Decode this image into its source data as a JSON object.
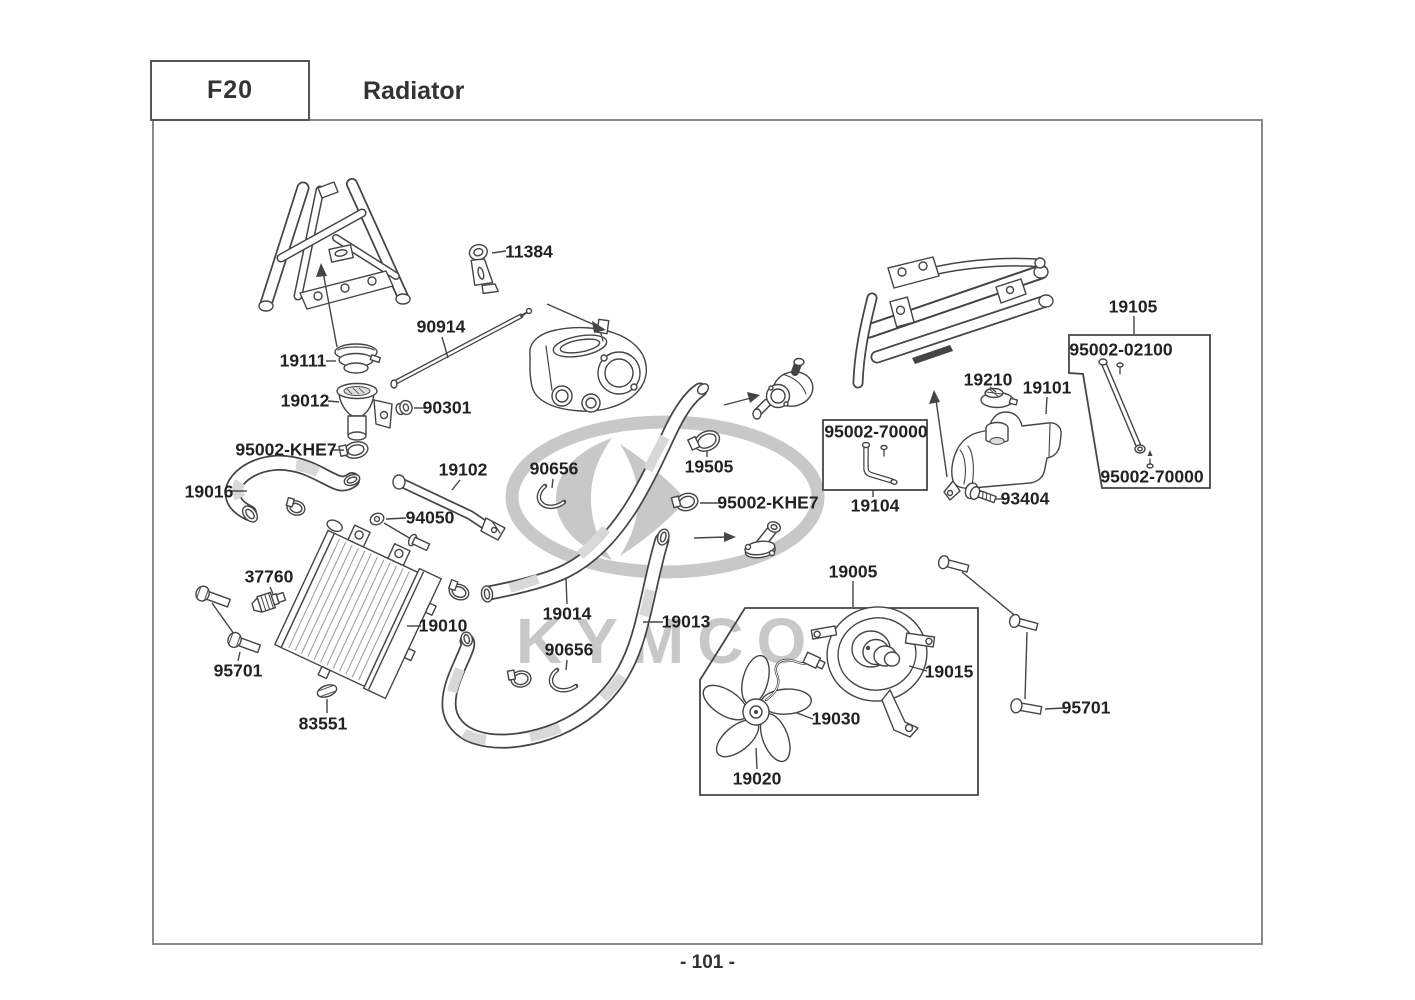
{
  "theme": {
    "line_color": "#454545",
    "label_color": "#222222",
    "watermark_color": "#c8c8c8",
    "border_color": "#8a8a8a"
  },
  "header": {
    "section_code": "F20",
    "section_title": "Radiator"
  },
  "footer": {
    "page_number": "- 101 -"
  },
  "watermark": {
    "brand": "KYMCO"
  },
  "diagram": {
    "labels": [
      {
        "id": "11384",
        "text": "11384",
        "x": 529,
        "y": 252
      },
      {
        "id": "90914",
        "text": "90914",
        "x": 441,
        "y": 327
      },
      {
        "id": "19111",
        "text": "19111",
        "x": 303,
        "y": 361
      },
      {
        "id": "19012",
        "text": "19012",
        "x": 305,
        "y": 401
      },
      {
        "id": "90301",
        "text": "90301",
        "x": 447,
        "y": 408
      },
      {
        "id": "95002-khe7-a",
        "text": "95002-KHE7",
        "x": 286,
        "y": 450
      },
      {
        "id": "19016",
        "text": "19016",
        "x": 209,
        "y": 492
      },
      {
        "id": "19102",
        "text": "19102",
        "x": 463,
        "y": 470
      },
      {
        "id": "90656-a",
        "text": "90656",
        "x": 554,
        "y": 469
      },
      {
        "id": "19505",
        "text": "19505",
        "x": 709,
        "y": 467
      },
      {
        "id": "95002-khe7-b",
        "text": "95002-KHE7",
        "x": 768,
        "y": 503
      },
      {
        "id": "94050",
        "text": "94050",
        "x": 430,
        "y": 518
      },
      {
        "id": "37760",
        "text": "37760",
        "x": 269,
        "y": 577
      },
      {
        "id": "19010",
        "text": "19010",
        "x": 443,
        "y": 626
      },
      {
        "id": "19014",
        "text": "19014",
        "x": 567,
        "y": 614
      },
      {
        "id": "19013",
        "text": "19013",
        "x": 686,
        "y": 622
      },
      {
        "id": "90656-b",
        "text": "90656",
        "x": 569,
        "y": 650
      },
      {
        "id": "95701-left",
        "text": "95701",
        "x": 238,
        "y": 671
      },
      {
        "id": "83551",
        "text": "83551",
        "x": 323,
        "y": 724
      },
      {
        "id": "19005",
        "text": "19005",
        "x": 853,
        "y": 572
      },
      {
        "id": "19015",
        "text": "19015",
        "x": 949,
        "y": 672
      },
      {
        "id": "19030",
        "text": "19030",
        "x": 836,
        "y": 719
      },
      {
        "id": "19020",
        "text": "19020",
        "x": 757,
        "y": 779
      },
      {
        "id": "95701-right",
        "text": "95701",
        "x": 1086,
        "y": 708
      },
      {
        "id": "19105",
        "text": "19105",
        "x": 1133,
        "y": 307
      },
      {
        "id": "95002-02100",
        "text": "95002-02100",
        "x": 1121,
        "y": 350
      },
      {
        "id": "95002-70000-rod",
        "text": "95002-70000",
        "x": 1152,
        "y": 477
      },
      {
        "id": "19210",
        "text": "19210",
        "x": 988,
        "y": 380
      },
      {
        "id": "19101",
        "text": "19101",
        "x": 1047,
        "y": 388
      },
      {
        "id": "95002-70000-pipe",
        "text": "95002-70000",
        "x": 876,
        "y": 432
      },
      {
        "id": "19104",
        "text": "19104",
        "x": 875,
        "y": 506
      },
      {
        "id": "93404",
        "text": "93404",
        "x": 1025,
        "y": 499
      }
    ]
  }
}
